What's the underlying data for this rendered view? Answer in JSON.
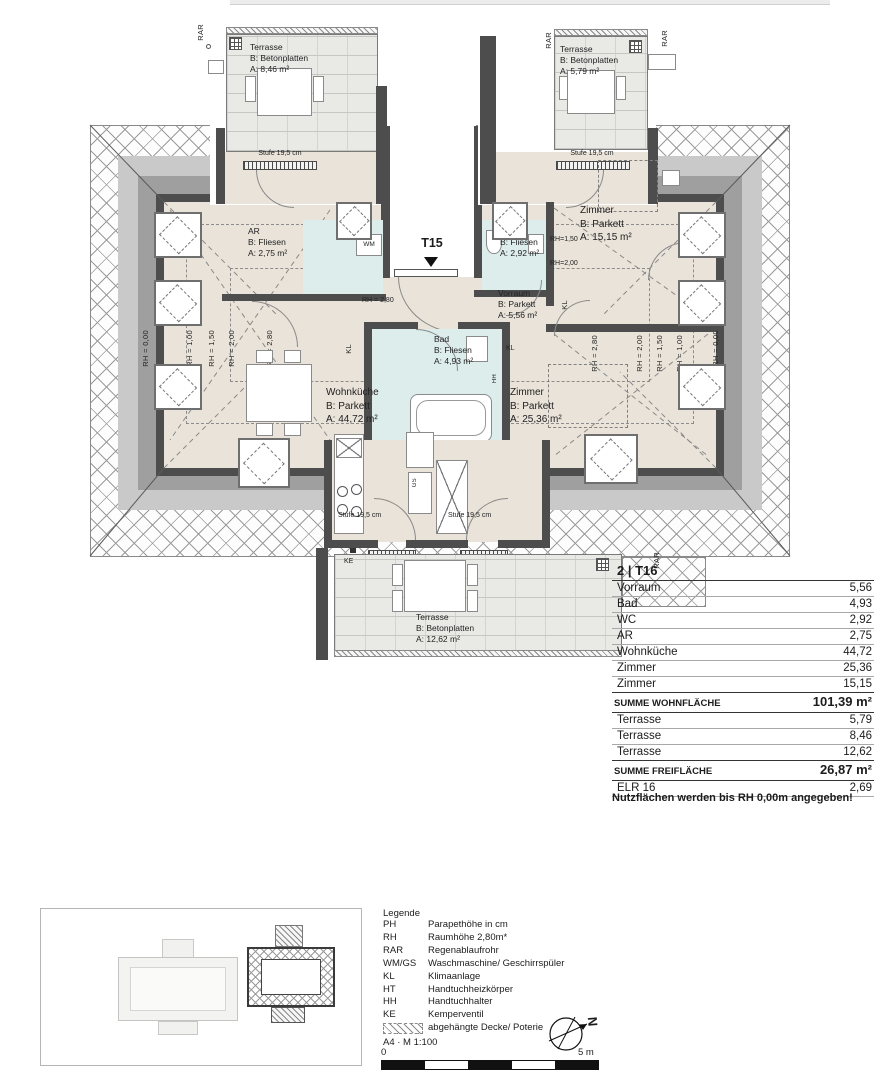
{
  "plan": {
    "unit_label": "T15",
    "stufe_label": "Stufe 19,5 cm",
    "rooms": {
      "terrasse_tl": {
        "name": "Terrasse",
        "finish": "B: Betonplatten",
        "area": "A: 8,46 m²"
      },
      "terrasse_tr": {
        "name": "Terrasse",
        "finish": "B: Betonplatten",
        "area": "A: 5,79 m²"
      },
      "terrasse_b": {
        "name": "Terrasse",
        "finish": "B: Betonplatten",
        "area": "A: 12,62 m²"
      },
      "ar": {
        "name": "AR",
        "finish": "B: Fliesen",
        "area": "A: 2,75 m²"
      },
      "wc": {
        "name": "WC",
        "finish": "B: Fliesen",
        "area": "A: 2,92 m²"
      },
      "bad": {
        "name": "Bad",
        "finish": "B: Fliesen",
        "area": "A: 4,93 m²"
      },
      "vorraum": {
        "name": "Vorraum",
        "finish": "B: Parkett",
        "area": "A: 5,56 m²"
      },
      "wohnkueche": {
        "name": "Wohnküche",
        "finish": "B: Parkett",
        "area": "A: 44,72 m²"
      },
      "zimmer_klein": {
        "name": "Zimmer",
        "finish": "B: Parkett",
        "area": "A: 15,15 m²"
      },
      "zimmer_gross": {
        "name": "Zimmer",
        "finish": "B: Parkett",
        "area": "A: 25,36 m²"
      }
    },
    "rh": {
      "rh000": "RH = 0,00",
      "rh100": "RH = 1,00",
      "rh150": "RH = 1,50",
      "rh200": "RH = 2,00",
      "rh280": "RH = 2,80",
      "wc150": "RH=1,50",
      "wc200": "RH=2,00"
    },
    "markers": {
      "rar": "RAR",
      "ke": "KE",
      "kl": "KL",
      "wm": "WM",
      "gs": "GS",
      "hh": "HH"
    }
  },
  "area_table": {
    "title": "2 | T16",
    "rows": [
      {
        "label": "Vorraum",
        "value": "5,56"
      },
      {
        "label": "Bad",
        "value": "4,93"
      },
      {
        "label": "WC",
        "value": "2,92"
      },
      {
        "label": "AR",
        "value": "2,75"
      },
      {
        "label": "Wohnküche",
        "value": "44,72"
      },
      {
        "label": "Zimmer",
        "value": "25,36"
      },
      {
        "label": "Zimmer",
        "value": "15,15"
      }
    ],
    "sum_living": {
      "label": "SUMME WOHNFLÄCHE",
      "value": "101,39 m²"
    },
    "terrace_rows": [
      {
        "label": "Terrasse",
        "value": "5,79"
      },
      {
        "label": "Terrasse",
        "value": "8,46"
      },
      {
        "label": "Terrasse",
        "value": "12,62"
      }
    ],
    "sum_free": {
      "label": "SUMME FREIFLÄCHE",
      "value": "26,87 m²"
    },
    "extra_row": {
      "label": "ELR 16",
      "value": "2,69"
    },
    "note": "Nutzflächen werden bis RH 0,00m angegeben!"
  },
  "legend": {
    "title": "Legende",
    "entries": [
      {
        "abbr": "PH",
        "text": "Parapethöhe in cm"
      },
      {
        "abbr": "RH",
        "text": "Raumhöhe 2,80m*"
      },
      {
        "abbr": "RAR",
        "text": "Regenablaufrohr"
      },
      {
        "abbr": "WM/GS",
        "text": "Waschmaschine/ Geschirrspüler"
      },
      {
        "abbr": "KL",
        "text": "Klimaanlage"
      },
      {
        "abbr": "HT",
        "text": "Handtuchheizkörper"
      },
      {
        "abbr": "HH",
        "text": "Handtuchhalter"
      },
      {
        "abbr": "KE",
        "text": "Kemperventil"
      },
      {
        "abbr": "",
        "text": "abgehängte Decke/ Poterie"
      }
    ],
    "format_scale": "A4 · M 1:100",
    "scale_zero": "0",
    "scale_max": "5 m",
    "north_letter": "N"
  }
}
